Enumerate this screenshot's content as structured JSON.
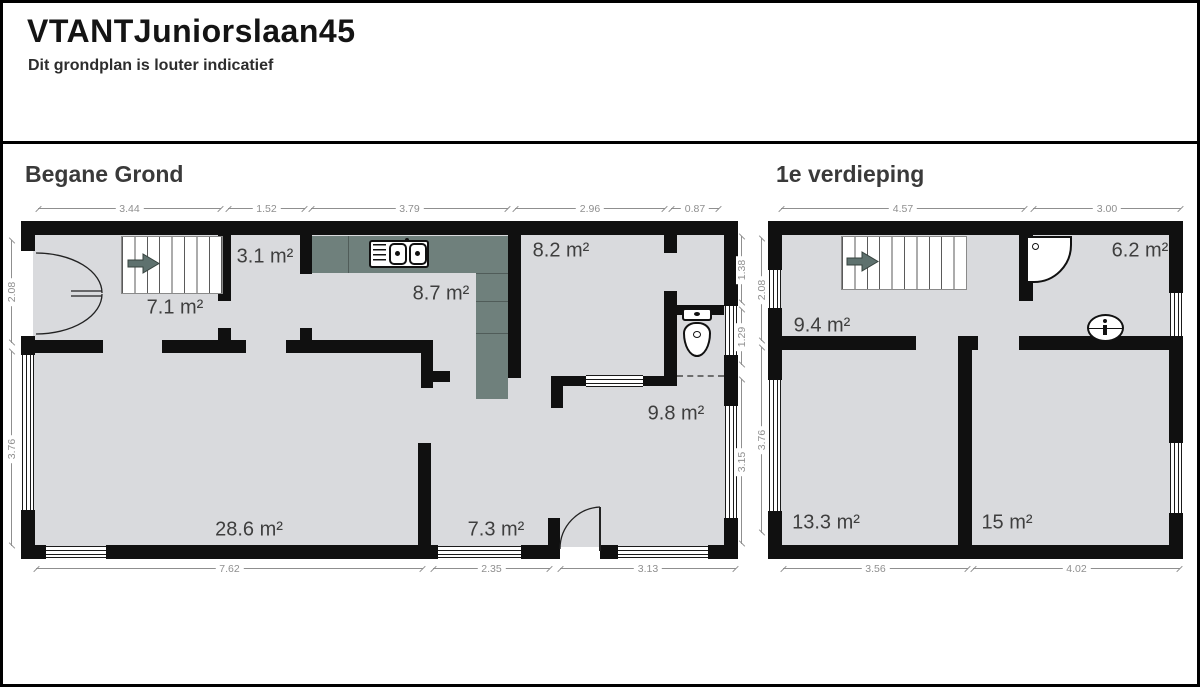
{
  "header": {
    "title": "VTANTJuniorslaan45",
    "subtitle": "Dit grondplan is louter indicatief"
  },
  "plans": {
    "ground": {
      "heading": "Begane Grond",
      "rooms": [
        {
          "name": "hal",
          "area": "7.1 m²"
        },
        {
          "name": "trapkast",
          "area": "3.1 m²"
        },
        {
          "name": "keuken",
          "area": "8.7 m²"
        },
        {
          "name": "kamer-rechtsboven",
          "area": "8.2 m²"
        },
        {
          "name": "kamer-rechtsonder",
          "area": "9.8 m²"
        },
        {
          "name": "woonkamer",
          "area": "28.6 m²"
        },
        {
          "name": "kamer-midden",
          "area": "7.3 m²"
        }
      ],
      "dims": {
        "top": [
          "3.44",
          "1.52",
          "3.79",
          "2.96",
          "0.87"
        ],
        "bottom": [
          "7.62",
          "2.35",
          "3.13"
        ],
        "left": [
          "2.08",
          "3.76"
        ],
        "right": [
          "1.38",
          "1.29",
          "3.15"
        ]
      }
    },
    "first": {
      "heading": "1e verdieping",
      "rooms": [
        {
          "name": "overloop",
          "area": "9.4 m²"
        },
        {
          "name": "badkamer",
          "area": "6.2 m²"
        },
        {
          "name": "slaapkamer-1",
          "area": "13.3 m²"
        },
        {
          "name": "slaapkamer-2",
          "area": "15 m²"
        }
      ],
      "dims": {
        "top": [
          "4.57",
          "3.00"
        ],
        "bottom": [
          "3.56",
          "4.02"
        ],
        "left": [
          "2.08",
          "3.76"
        ]
      }
    }
  },
  "icons": {
    "stair_arrow": "stair-direction-arrow",
    "kitchen_sink": "double-sink-with-drainer",
    "toilet": "toilet",
    "shower": "corner-shower-tray",
    "washbasin": "washbasin"
  },
  "colors": {
    "wall": "#101010",
    "floor": "#d9dadd",
    "counter": "#6f807c",
    "dimension": "#8f8f8f",
    "room_label": "#3e3e3e"
  }
}
